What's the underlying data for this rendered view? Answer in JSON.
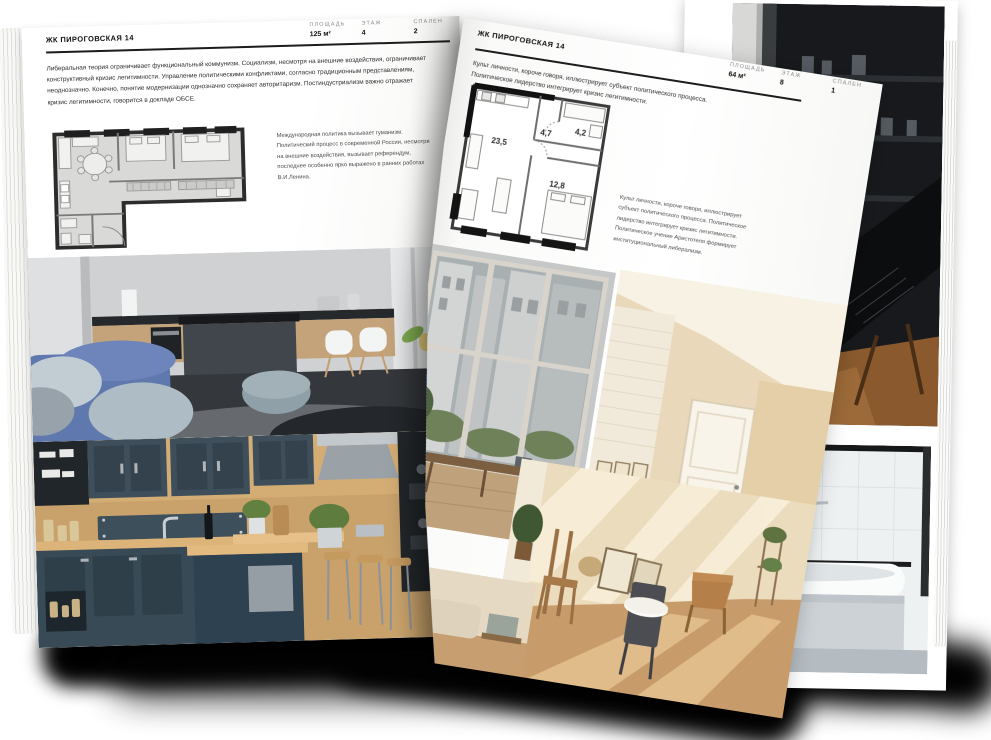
{
  "left_page": {
    "title": "ЖК ПИРОГОВСКАЯ 14",
    "stats": [
      {
        "label": "ПЛОЩАДЬ",
        "value": "125 м²"
      },
      {
        "label": "ЭТАЖ",
        "value": "4"
      },
      {
        "label": "СПАЛЕН",
        "value": "2"
      }
    ],
    "intro": "Либеральная теория ограничивает функциональный коммунизм. Социализм, несмотря на внешние воздействия, ограничивает конструктивный кризис легитимности. Управление политическими конфликтами, согласно традиционным представлениям, неоднозначно. Конечно, понятие модернизации однозначно сохраняет авторитаризм. Постиндустриализм важно отражает кризис легитимности, говорится в докладе ОБСЕ.",
    "plan_note": "Международная политика вызывает гуманизм. Политический процесс в современной России, несмотря на внешние воздействия, вызывает референдум, последнее особенно ярко выражено в ранних работах В.И.Ленина.",
    "photos": [
      "grey-kitchen-living-room",
      "dark-teal-kitchen"
    ]
  },
  "right_page": {
    "title": "ЖК ПИРОГОВСКАЯ 14",
    "stats": [
      {
        "label": "ПЛОЩАДЬ",
        "value": "64 м²"
      },
      {
        "label": "ЭТАЖ",
        "value": "8"
      },
      {
        "label": "СПАЛЕН",
        "value": "1"
      }
    ],
    "intro": "Культ личности, короче говоря, иллюстрирует субъект политического процесса. Политическое лидерство интегрирует кризис легитимности.",
    "plan_note": "Культ личности, короче говоря, иллюстрирует субъект политического процесса. Политическое лидерство интегрирует кризис легитимности. Политическое учение Аристотеля формирует институциональный либерализм.",
    "floor_plan": {
      "room_areas": [
        "23,5",
        "4,7",
        "4,2",
        "12,8"
      ]
    },
    "photos": [
      "loft-window-view",
      "beige-attic-hallway",
      "sunlit-wooden-room",
      "beige-living-room",
      "dark-loft-stairs",
      "white-bathroom"
    ]
  },
  "colors": {
    "page": "#fdfdfc",
    "ink": "#1d1d1d",
    "muted_label": "#8b8b8b",
    "plan_fill": "#d9d9d7",
    "plan_wall": "#2c2c2c",
    "sofa_blue": "#5f78ae",
    "vase_blue": "#2d63b8",
    "kitchen_teal": "#3c4f5b",
    "wood": "#c9a26b",
    "beige": "#e7d4b4"
  }
}
